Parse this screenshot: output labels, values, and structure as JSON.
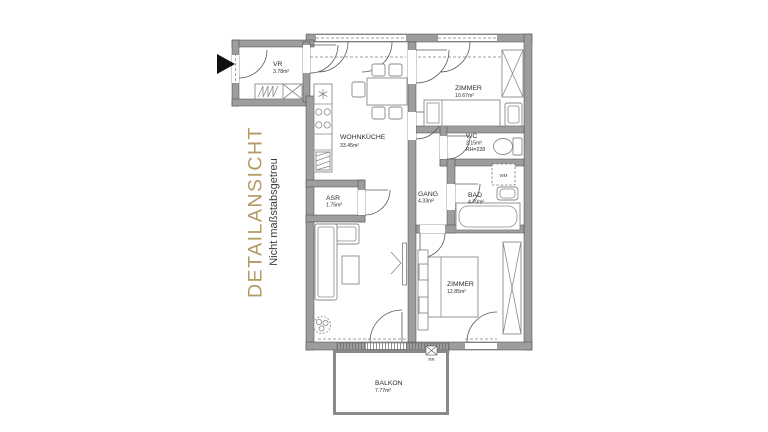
{
  "side_label": {
    "title": "DETAILANSICHT",
    "subtitle": "Nicht maßstabsgetreu"
  },
  "colors": {
    "accent_gold": "#b49a63",
    "wall_gray": "#9d9d9d",
    "background": "#ffffff"
  },
  "floorplan": {
    "rooms": [
      {
        "id": "vr",
        "name": "VR",
        "area": "3.78m²"
      },
      {
        "id": "wohnkueche",
        "name": "WOHNKÜCHE",
        "area": "33.45m²"
      },
      {
        "id": "zimmer1",
        "name": "ZIMMER",
        "area": "10.67m²"
      },
      {
        "id": "wc",
        "name": "WC",
        "area": "2.15m²",
        "note": "RH=228"
      },
      {
        "id": "gang",
        "name": "GANG",
        "area": "4.33m²"
      },
      {
        "id": "bad",
        "name": "BAD",
        "area": "4.70m²"
      },
      {
        "id": "asr",
        "name": "ASR",
        "area": "1.75m²"
      },
      {
        "id": "zimmer2",
        "name": "ZIMMER",
        "area": "12.85m²"
      },
      {
        "id": "balkon",
        "name": "BALKON",
        "area": "7.77m²"
      }
    ],
    "labels": {
      "washing_machine": "WM",
      "rain_pipe": "RR"
    }
  }
}
